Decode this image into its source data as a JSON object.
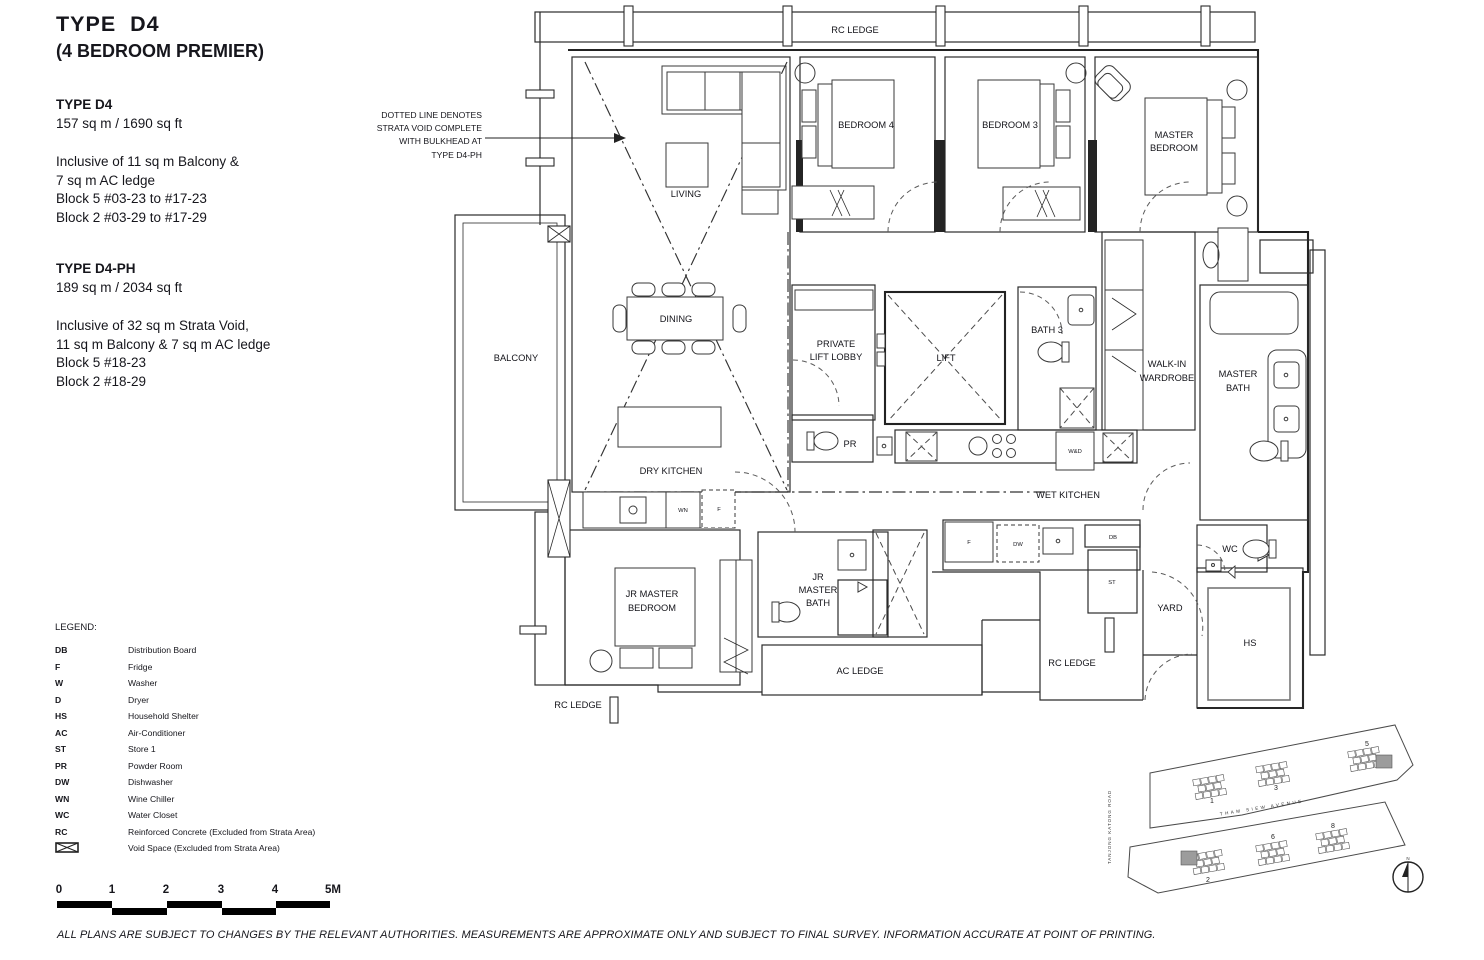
{
  "header": {
    "title": "TYPE  D4",
    "subtitle": "(4 BEDROOM PREMIER)"
  },
  "info": {
    "sections": [
      {
        "heading": "TYPE D4",
        "area": "157 sq m / 1690 sq ft",
        "lines": [
          "Inclusive of 11 sq m Balcony &",
          "7 sq m AC ledge",
          "Block 5 #03-23 to #17-23",
          "Block 2 #03-29 to #17-29"
        ]
      },
      {
        "heading": "TYPE D4-PH",
        "area": "189 sq m / 2034 sq ft",
        "lines": [
          "Inclusive of 32 sq m Strata Void,",
          "11 sq m Balcony & 7 sq m AC ledge",
          "Block 5 #18-23",
          "Block 2 #18-29"
        ]
      }
    ]
  },
  "annotation": {
    "lines": [
      "DOTTED LINE DENOTES",
      "STRATA VOID COMPLETE",
      "WITH BULKHEAD AT",
      "TYPE D4-PH"
    ]
  },
  "plan": {
    "labels": {
      "rc_ledge_top": "RC LEDGE",
      "living": "LIVING",
      "bedroom4": "BEDROOM 4",
      "bedroom3": "BEDROOM 3",
      "master_bedroom": [
        "MASTER",
        "BEDROOM"
      ],
      "balcony": "BALCONY",
      "dining": "DINING",
      "private_lift_lobby": [
        "PRIVATE",
        "LIFT LOBBY"
      ],
      "lift": "LIFT",
      "bath3": "BATH 3",
      "walkin": [
        "WALK-IN",
        "WARDROBE"
      ],
      "master_bath": [
        "MASTER",
        "BATH"
      ],
      "pr": "PR",
      "dry_kitchen": "DRY KITCHEN",
      "wet_kitchen": "WET KITCHEN",
      "wd": "W&D",
      "wn": "WN",
      "f_dry": "F",
      "f_wet": "F",
      "dw": "DW",
      "db": "DB",
      "st": "ST",
      "wc": "WC",
      "yard": "YARD",
      "hs": "HS",
      "jr_bedroom": [
        "JR MASTER",
        "BEDROOM"
      ],
      "jr_bath": [
        "JR",
        "MASTER",
        "BATH"
      ],
      "ac_ledge": "AC LEDGE",
      "rc_ledge_bl": "RC LEDGE",
      "rc_ledge_br": "RC LEDGE"
    }
  },
  "legend": {
    "title": "LEGEND:",
    "items": [
      {
        "abbr": "DB",
        "desc": "Distribution Board"
      },
      {
        "abbr": "F",
        "desc": "Fridge"
      },
      {
        "abbr": "W",
        "desc": "Washer"
      },
      {
        "abbr": "D",
        "desc": "Dryer"
      },
      {
        "abbr": "HS",
        "desc": "Household Shelter"
      },
      {
        "abbr": "AC",
        "desc": "Air-Conditioner"
      },
      {
        "abbr": "ST",
        "desc": "Store 1"
      },
      {
        "abbr": "PR",
        "desc": "Powder Room"
      },
      {
        "abbr": "DW",
        "desc": "Dishwasher"
      },
      {
        "abbr": "WN",
        "desc": "Wine Chiller"
      },
      {
        "abbr": "WC",
        "desc": "Water Closet"
      },
      {
        "abbr": "RC",
        "desc": "Reinforced Concrete (Excluded from Strata Area)"
      }
    ],
    "void_item": {
      "desc": "Void Space (Excluded from Strata Area)"
    }
  },
  "scalebar": {
    "ticks": [
      "0",
      "1",
      "2",
      "3",
      "4",
      "5M"
    ]
  },
  "site_plan": {
    "road_left": "TANJONG KATONG ROAD",
    "avenue": "THAM SIEW AVENUE",
    "blocks": [
      "1",
      "3",
      "5",
      "2",
      "6",
      "8"
    ],
    "north": "N"
  },
  "disclaimer": "ALL PLANS ARE SUBJECT TO CHANGES BY THE RELEVANT AUTHORITIES. MEASUREMENTS ARE APPROXIMATE ONLY AND SUBJECT TO FINAL SURVEY. INFORMATION ACCURATE AT POINT OF PRINTING.",
  "colors": {
    "ink": "#1f1f1f",
    "highlight": "#9c9c9c"
  }
}
